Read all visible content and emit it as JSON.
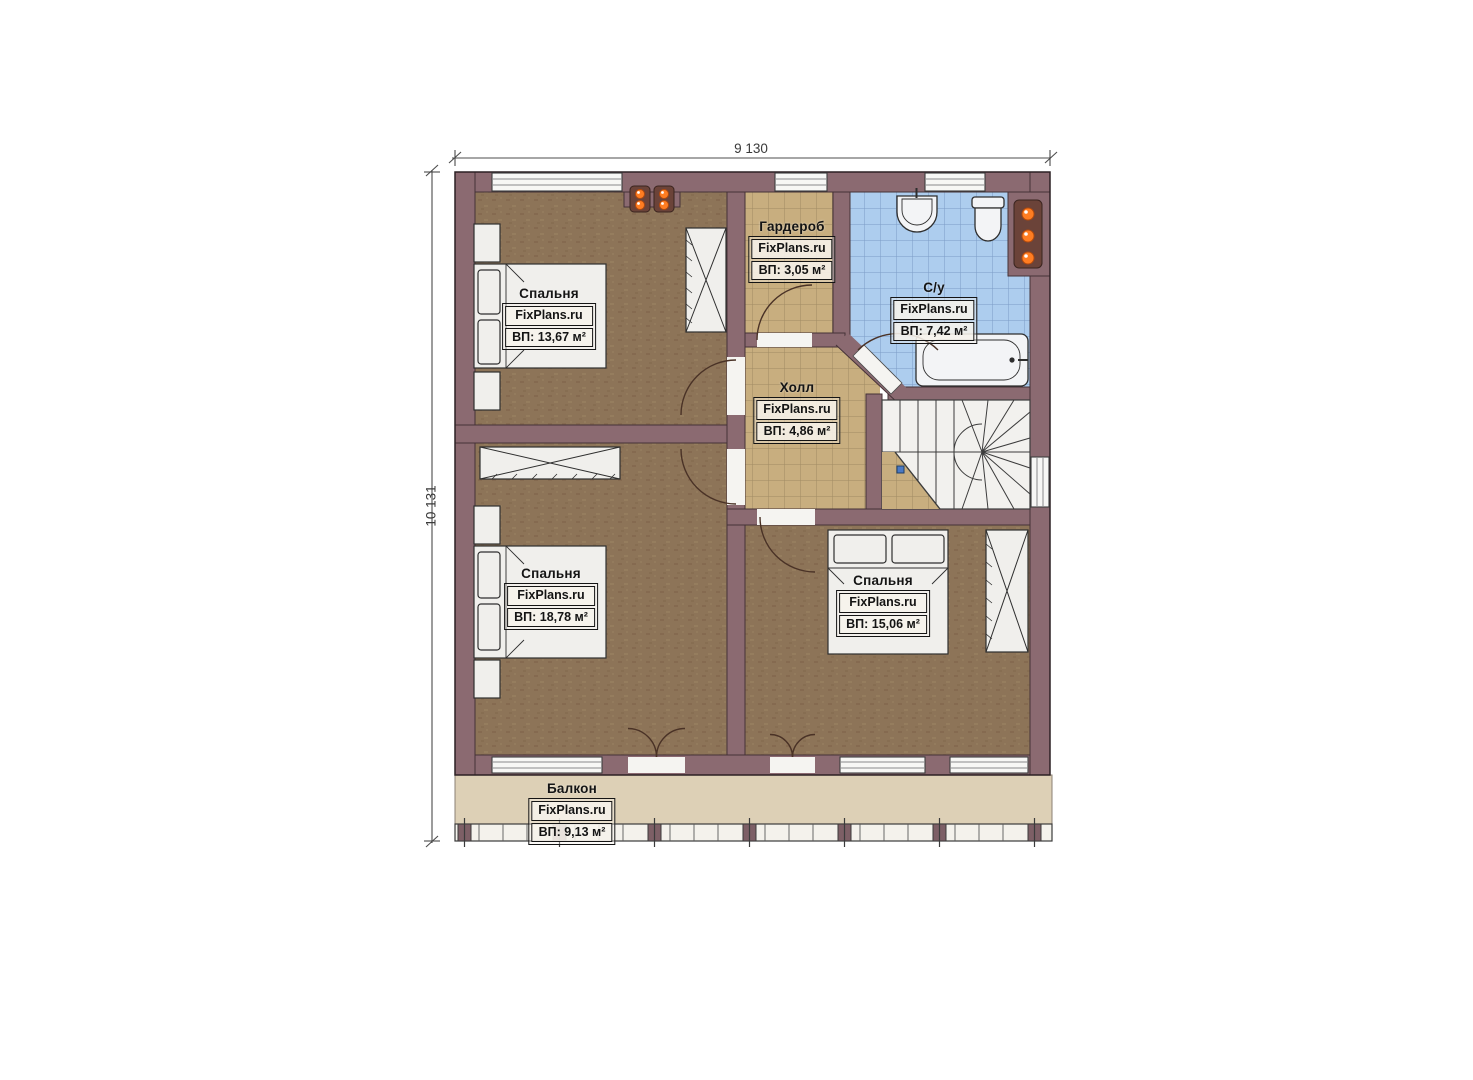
{
  "plan": {
    "type": "floor-plan",
    "brand": "FixPlans.ru"
  },
  "dimensions": {
    "width_label": "9 130",
    "height_label": "10 131"
  },
  "rooms": [
    {
      "id": "bedroom-top-left",
      "name": "Спальня",
      "brand": "FixPlans.ru",
      "area": "ВП: 13,67 м²"
    },
    {
      "id": "wardrobe",
      "name": "Гардероб",
      "brand": "FixPlans.ru",
      "area": "ВП: 3,05 м²"
    },
    {
      "id": "bathroom",
      "name": "С/у",
      "brand": "FixPlans.ru",
      "area": "ВП: 7,42 м²"
    },
    {
      "id": "hall",
      "name": "Холл",
      "brand": "FixPlans.ru",
      "area": "ВП: 4,86 м²"
    },
    {
      "id": "bedroom-middle",
      "name": "Спальня",
      "brand": "FixPlans.ru",
      "area": "ВП: 18,78 м²"
    },
    {
      "id": "bedroom-right",
      "name": "Спальня",
      "brand": "FixPlans.ru",
      "area": "ВП: 15,06 м²"
    },
    {
      "id": "balcony",
      "name": "Балкон",
      "brand": "FixPlans.ru",
      "area": "ВП: 9,13 м²"
    }
  ],
  "colors": {
    "wall": "#8b6a71",
    "bedroom_floor": "#8d7458",
    "tile_tan": "#c8ae7f",
    "tile_blue": "#adcdee",
    "balcony_floor": "#ddd0b6",
    "radiator_accent": "#ff7d22",
    "furniture": "#f0efec"
  }
}
